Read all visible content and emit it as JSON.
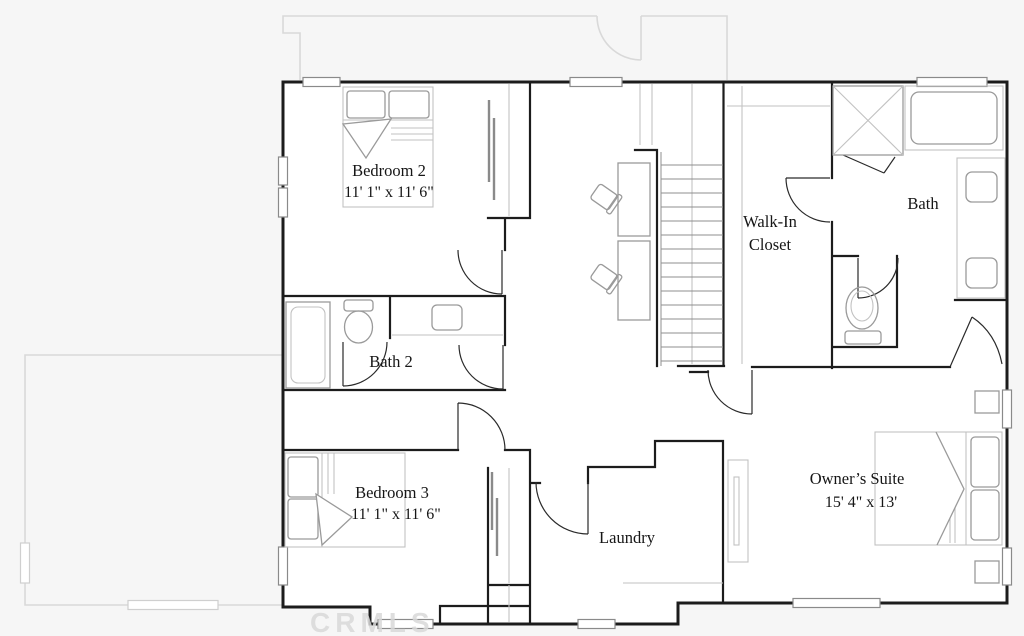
{
  "watermark": "CRMLS",
  "rooms": {
    "bedroom2": {
      "name": "Bedroom 2",
      "dims": "11' 1\" x 11' 6\""
    },
    "bath2": {
      "name": "Bath 2"
    },
    "walk_in_closet": {
      "line1": "Walk-In",
      "line2": "Closet"
    },
    "bath": {
      "name": "Bath"
    },
    "bedroom3": {
      "name": "Bedroom 3",
      "dims": "11' 1\" x 11' 6\""
    },
    "laundry": {
      "name": "Laundry"
    },
    "owners_suite": {
      "name": "Owner’s Suite",
      "dims": "15' 4\" x 13'"
    }
  },
  "colors": {
    "wall": "#1c1c1c",
    "fixture": "#9a9a9a",
    "ghost_outline": "#d9d9d9",
    "background": "#f6f6f6",
    "paper": "#ffffff",
    "label_text": "#161616",
    "watermark": "#d9d9d9"
  }
}
